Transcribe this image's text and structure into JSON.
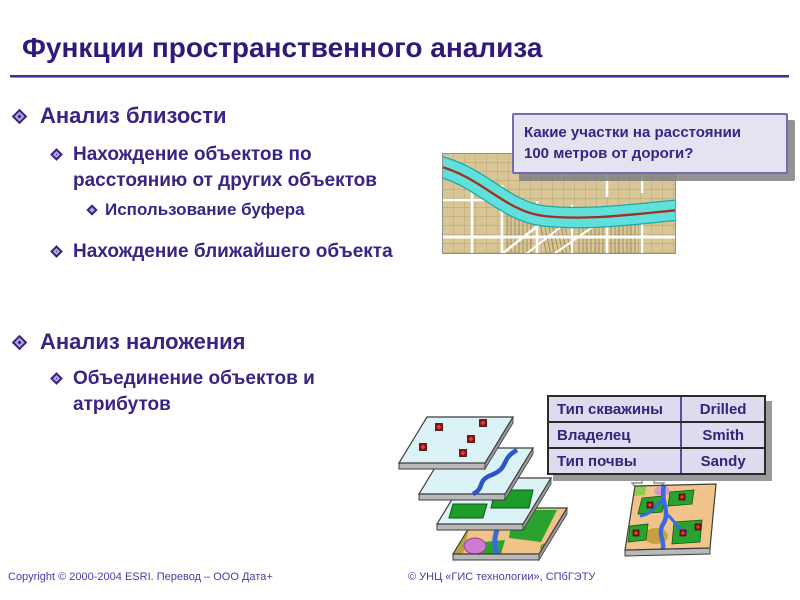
{
  "slide": {
    "title": "Функции пространственного анализа",
    "bullets": {
      "b1": "Анализ близости",
      "b2_line1": "Нахождение объектов по",
      "b2_line2": "расстоянию от других объектов",
      "b3": "Использование буфера",
      "b4": "Нахождение ближайшего объекта",
      "b5": "Анализ наложения",
      "b6_line1": "Объединение объектов и",
      "b6_line2": "атрибутов"
    },
    "callout": {
      "line1": "Какие участки на расстоянии",
      "line2": "100 метров от дороги?"
    },
    "attribute_table": {
      "rows": [
        {
          "label": "Тип скважины",
          "value": "Drilled"
        },
        {
          "label": "Владелец",
          "value": "Smith"
        },
        {
          "label": "Тип почвы",
          "value": "Sandy"
        }
      ]
    },
    "footer": {
      "left": "Copyright © 2000-2004 ESRI. Перевод – ООО Дата+",
      "right": "© УНЦ «ГИС технологии», СПбГЭТУ"
    },
    "icons": [
      "diamond-bullet-icon",
      "buffer-map-image",
      "down-arrow-icon",
      "layer-stack-image",
      "overlay-map-image"
    ],
    "colors": {
      "title_text": "#31197b",
      "body_text": "#3a2384",
      "rule": "#4b2e91",
      "callout_bg": "#e4e3f2",
      "callout_border": "#7b68b5",
      "table_bg": "#dcdcee",
      "map_tan": "#d8c697",
      "buffer_cyan": "#5fe0da",
      "road_red": "#a52d24",
      "shadow_gray": "#999999"
    }
  }
}
